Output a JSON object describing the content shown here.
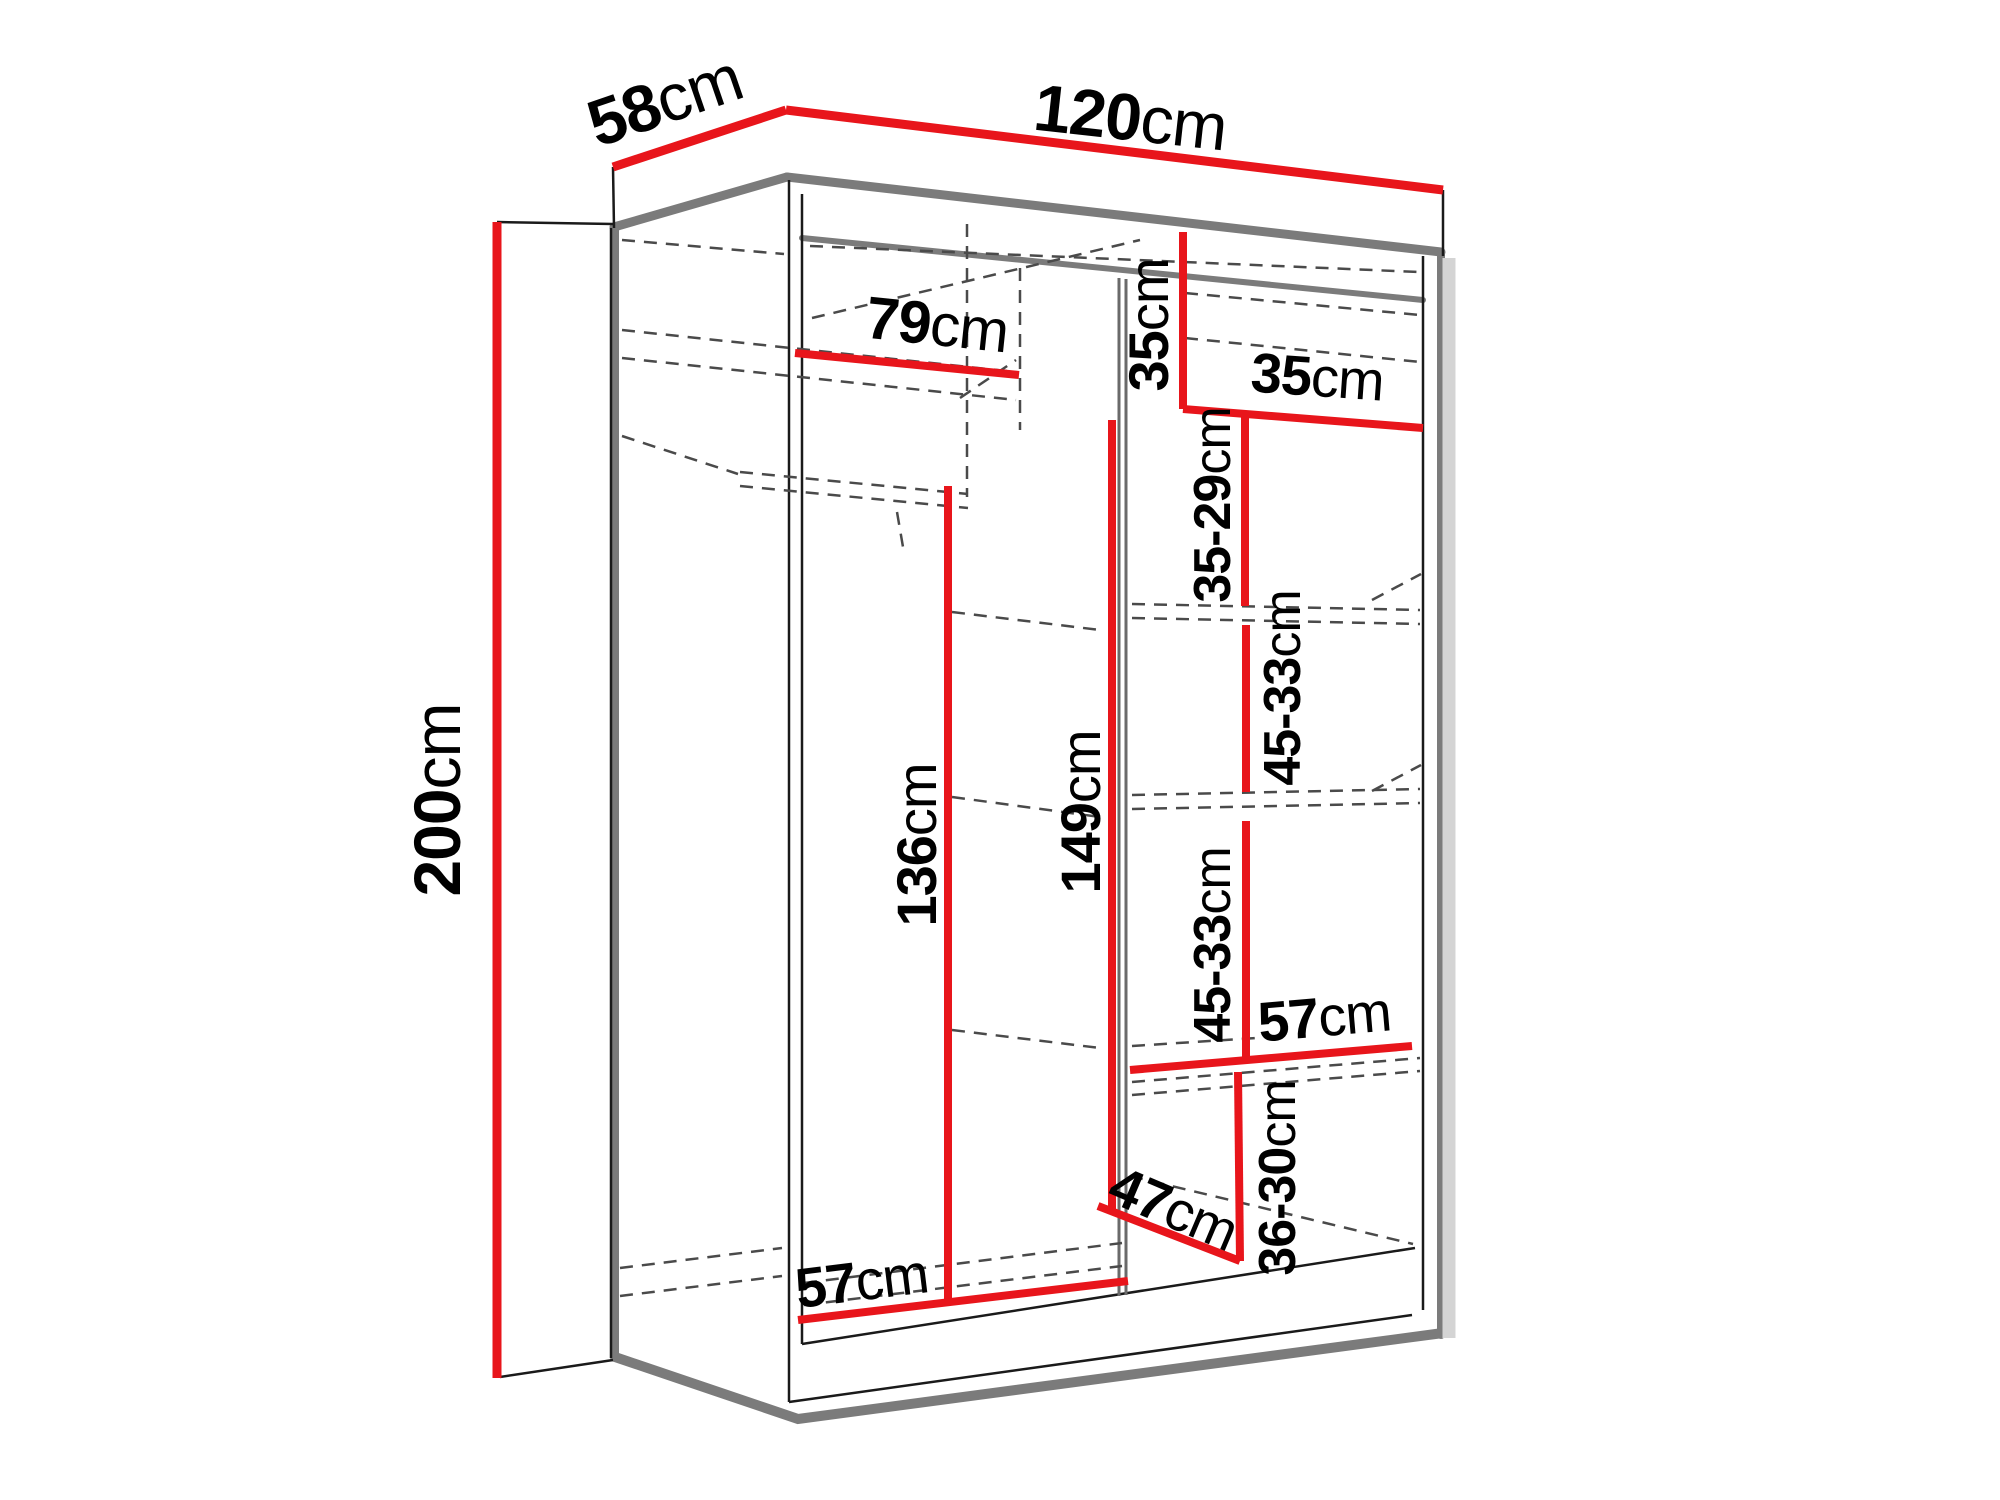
{
  "diagram": {
    "type": "wardrobe-dimension-drawing",
    "unit": "cm",
    "colors": {
      "dimension_line": "#e8151b",
      "structure_thin": "#1a1a1a",
      "structure_thick": "#7b7b7b",
      "divider_gray": "#6a6a6a",
      "dashed_line": "#4a4a4a",
      "shadow": "#d4d4d4",
      "background": "#ffffff",
      "text": "#000000"
    },
    "labels": {
      "depth": {
        "value": "58",
        "unit": "cm"
      },
      "width": {
        "value": "120",
        "unit": "cm"
      },
      "height": {
        "value": "200",
        "unit": "cm"
      },
      "top_shelf_width": {
        "value": "79",
        "unit": "cm"
      },
      "top_section_height": {
        "value": "35",
        "unit": "cm"
      },
      "top_right_shelf_width": {
        "value": "35",
        "unit": "cm"
      },
      "upper_shelf_gap": {
        "value": "35-29",
        "unit": "cm"
      },
      "middle_shelf_gap_1": {
        "value": "45-33",
        "unit": "cm"
      },
      "middle_shelf_gap_2": {
        "value": "45-33",
        "unit": "cm"
      },
      "hanging_space_height": {
        "value": "136",
        "unit": "cm"
      },
      "right_column_height": {
        "value": "149",
        "unit": "cm"
      },
      "right_shelf_width": {
        "value": "57",
        "unit": "cm"
      },
      "lower_shelf_gap": {
        "value": "36-30",
        "unit": "cm"
      },
      "shoe_shelf_depth": {
        "value": "47",
        "unit": "cm"
      },
      "left_section_width": {
        "value": "57",
        "unit": "cm"
      }
    }
  }
}
